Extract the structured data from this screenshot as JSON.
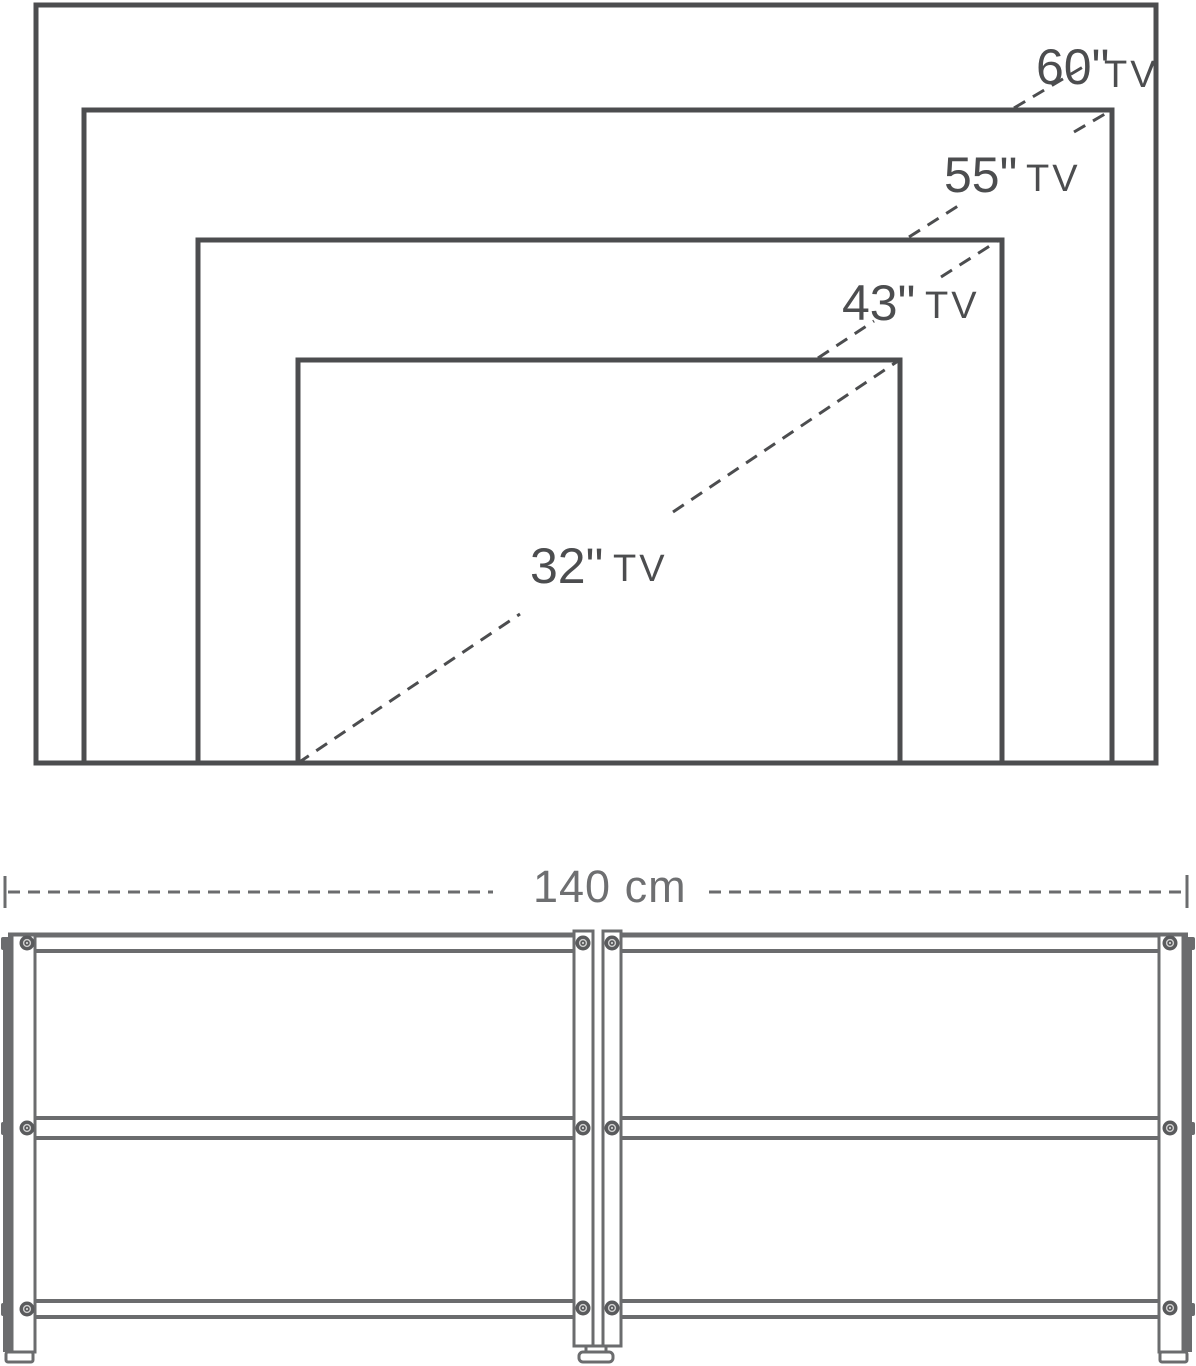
{
  "tv_size_diagram": {
    "sizes": [
      {
        "value": "60\"",
        "unit": "TV"
      },
      {
        "value": "55\"",
        "unit": "TV"
      },
      {
        "value": "43\"",
        "unit": "TV"
      },
      {
        "value": "32\"",
        "unit": "TV"
      }
    ]
  },
  "stand_dimension": {
    "width": "140 cm"
  },
  "colors": {
    "diagram_line": "#4c4d4f",
    "stand_line": "#6b6c6e",
    "dimension_text": "#6e6f71",
    "screw_fill": "#5a5b5d",
    "background": "#ffffff"
  }
}
